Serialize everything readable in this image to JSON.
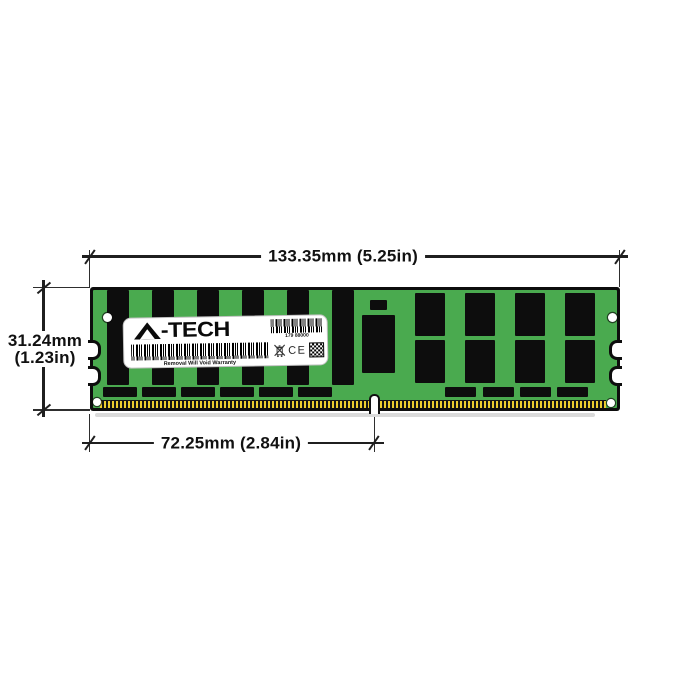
{
  "dimensions": {
    "width": "133.35mm (5.25in)",
    "height_mm": "31.24mm",
    "height_in": "(1.23in)",
    "pin_span": "72.25mm (2.84in)"
  },
  "module_label": {
    "brand": "A-TECH",
    "brand_wordmark": "-TECH",
    "serial": "179 88000",
    "warranty": "Removal Will Void Warranty",
    "ce_mark": "CE"
  },
  "icons": {
    "logo_triangle": "a-tech-triangle-logo-icon",
    "weee": "weee-crossed-bin-icon",
    "qr": "qr-code-icon",
    "serial_barcode": "serial-barcode",
    "main_barcode": "main-barcode"
  },
  "colors": {
    "pcb_green": "#4aaa4f",
    "chip_black": "#0d0d0d",
    "pin_gold": "#eccd2f",
    "dim_line": "#1f1f1f",
    "label_bg": "#ffffff"
  }
}
